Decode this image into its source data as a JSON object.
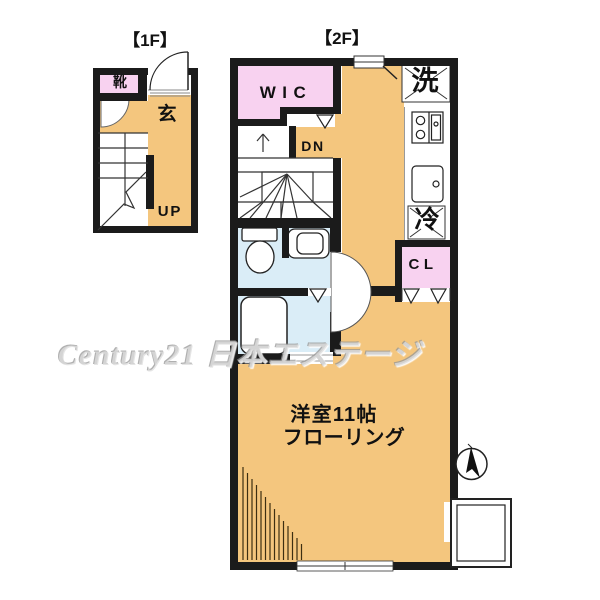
{
  "titles": {
    "floor1": "【1F】",
    "floor2": "【2F】"
  },
  "floor1": {
    "shoe_label": "靴",
    "entrance_label": "玄",
    "up_label": "UP"
  },
  "floor2": {
    "wic_label": "WIC",
    "washer_label": "洗",
    "down_label": "DN",
    "fridge_label": "冷",
    "closet_label": "CL",
    "room_label": "洋室11帖",
    "flooring_label": "フローリング"
  },
  "watermark": {
    "text": "Century21 日本エステージ"
  },
  "icons": {
    "compass_icon": "north-arrow"
  },
  "colors": {
    "floor": "#F4C67E",
    "closet_pink": "#F8D2F0",
    "wet_area_blue": "#DAEDF7",
    "wall": "#1B1B1B",
    "background": "#FFFFFF"
  }
}
